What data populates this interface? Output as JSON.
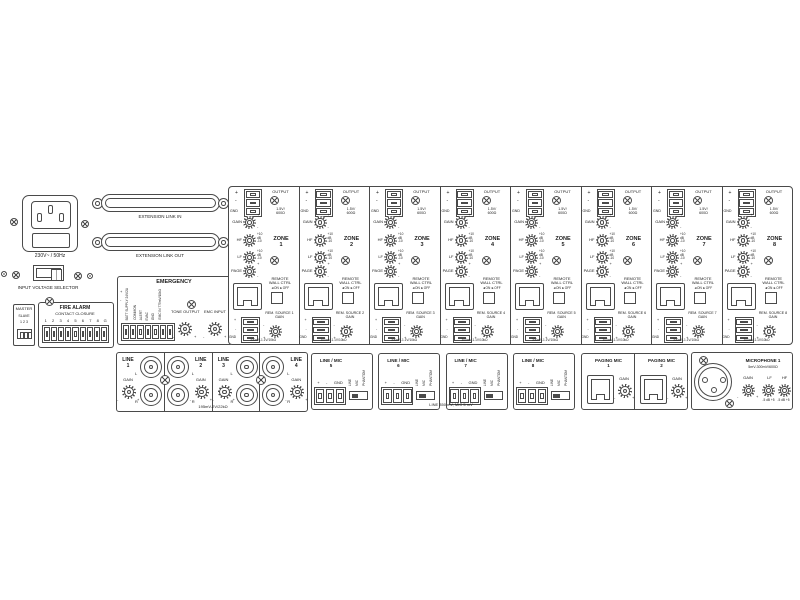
{
  "colors": {
    "line": "#4a4a4a",
    "text": "#1c1c1c",
    "bg": "#ffffff"
  },
  "panel": {
    "power": {
      "socket_spec": "230V~ / 50Hz",
      "selector_label": "INPUT VOLTAGE SELECTOR"
    },
    "master_switch": {
      "title": "MASTER",
      "row1": "SLAVE",
      "row2": "1 2 3"
    },
    "fire_alarm": {
      "title": "FIRE ALARM",
      "subtitle": "CONTACT CLOSURE",
      "terminals": [
        "1",
        "2",
        "3",
        "4",
        "5",
        "6",
        "7",
        "8",
        "G"
      ]
    },
    "extension": {
      "link_in": "EXTENSION LINK IN",
      "link_out": "EXTENSION LINK OUT"
    },
    "emergency": {
      "title": "EMERGENCY",
      "plus": "+",
      "minus": "-",
      "vertical_labels": [
        "BATT SUPPLY 24V/2A",
        "COMMON",
        "ALERT",
        "EVAC",
        "GND",
        "EMC IN 775mV/10kΩ"
      ],
      "tone_output": "TONE OUTPUT",
      "emc_input": "EMC INPUT"
    },
    "zones": {
      "common": {
        "plus": "+",
        "minus": "-",
        "gnd": "GND",
        "output": "OUTPUT",
        "output_spec_1": "1.5V/",
        "output_spec_2": "600Ω",
        "gain": "GAIN",
        "hf": "HF",
        "lf": "LF",
        "page": "PAGE",
        "eq_top": "+10",
        "eq_mid": "dB",
        "eq_bot": "-10",
        "zone_word": "ZONE",
        "remote_1": "REMOTE",
        "remote_2": "WALL CTRL",
        "on_off": "◄ON ►OFF",
        "rem_gain": "GAIN",
        "input_spec": "300mV-1.1V/10kΩ"
      },
      "items": [
        {
          "num": "1",
          "rem_source": "REM. SOURCE 1"
        },
        {
          "num": "2",
          "rem_source": "REM. SOURCE 2"
        },
        {
          "num": "3",
          "rem_source": "REM. SOURCE 3"
        },
        {
          "num": "4",
          "rem_source": "REM. SOURCE 4"
        },
        {
          "num": "5",
          "rem_source": "REM. SOURCE 5"
        },
        {
          "num": "6",
          "rem_source": "REM. SOURCE 6"
        },
        {
          "num": "7",
          "rem_source": "REM. SOURCE 7"
        },
        {
          "num": "8",
          "rem_source": "REM. SOURCE 8"
        }
      ]
    },
    "line_inputs": {
      "word": "LINE",
      "gain": "GAIN",
      "l": "L",
      "r": "R",
      "minus": "-",
      "plus": "+",
      "spec": "195mV-2V/22kΩ",
      "items": [
        {
          "num": "1"
        },
        {
          "num": "2"
        },
        {
          "num": "3"
        },
        {
          "num": "4"
        }
      ]
    },
    "line_mic": {
      "word": "LINE / MIC",
      "plus": "+",
      "minus": "-",
      "gnd": "GND",
      "switch_labels": [
        "LINE",
        "MIC",
        "PHANTOM"
      ],
      "spec": "LINE 350 mV, MIC 5 mV",
      "items": [
        {
          "num": "5"
        },
        {
          "num": "6"
        },
        {
          "num": "7"
        },
        {
          "num": "8"
        }
      ]
    },
    "paging": {
      "gain": "GAIN",
      "minus": "-",
      "plus": "+",
      "items": [
        {
          "title": "PAGING MIC",
          "num": "1"
        },
        {
          "title": "PAGING MIC",
          "num": "2"
        }
      ]
    },
    "microphone": {
      "title": "MICROPHONE 1",
      "spec": "5mV-300mV/600Ω",
      "gain": "GAIN",
      "lf": "LF",
      "hf": "HF",
      "scale": "-5 dB +5",
      "minus": "-",
      "plus": "+"
    }
  }
}
